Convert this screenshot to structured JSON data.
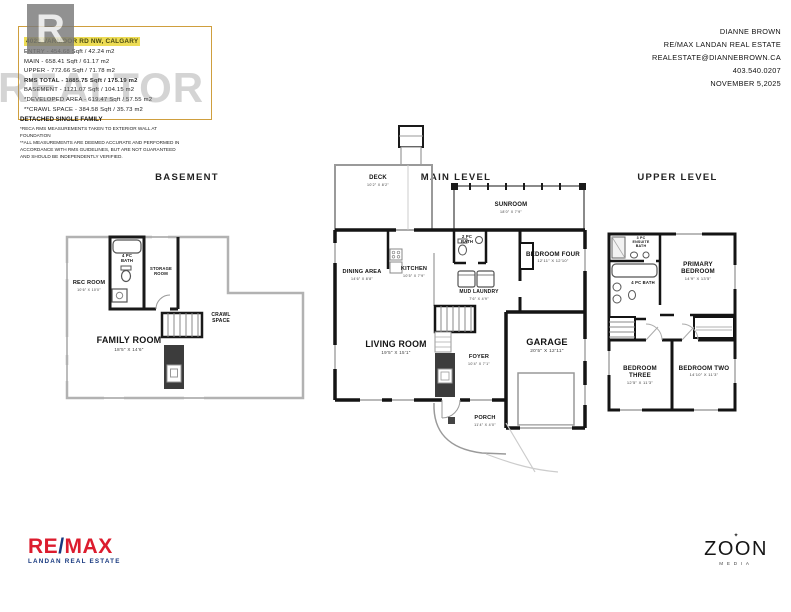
{
  "watermark": {
    "letter": "R",
    "text": "REALTOR"
  },
  "header": {
    "address": "4023 VARMOOR RD NW, CALGARY",
    "stats": [
      "ENTRY - 454.68 Sqft / 42.24 m2",
      "MAIN - 658.41 Sqft / 61.17 m2",
      "UPPER - 772.66 Sqft / 71.78 m2",
      "RMS TOTAL - 1885.75 Sqft / 175.19 m2",
      "BASEMENT - 1121.07 Sqft / 104.15 m2",
      "*DEVELOPED AREA - 619.47 Sqft / 57.55 m2",
      "**CRAWL SPACE - 384.58 Sqft / 35.73 m2"
    ],
    "property_type": "DETACHED SINGLE FAMILY",
    "disclaimer1": "*RECA RMS MEASUREMENTS TAKEN TO EXTERIOR WALL AT FOUNDATION",
    "disclaimer2": "**ALL MEASUREMENTS ARE DEEMED ACCURATE AND PERFORMED IN ACCORDANCE WITH RMS GUIDELINES, BUT ARE NOT GUARANTEED AND SHOULD BE INDEPENDENTLY VERIFIED."
  },
  "contact": {
    "name": "DIANNE BROWN",
    "brokerage": "RE/MAX LANDAN REAL ESTATE",
    "email": "REALESTATE@DIANNEBROWN.CA",
    "phone": "403.540.0207",
    "date": "NOVEMBER 5,2025"
  },
  "titles": {
    "basement": "BASEMENT",
    "main": "MAIN LEVEL",
    "upper": "UPPER LEVEL"
  },
  "plans": {
    "basement": {
      "rooms": {
        "rec": {
          "name": "REC ROOM",
          "dims": "10'6\" X 10'0\""
        },
        "bath": {
          "name": "4 PC BATH"
        },
        "storage": {
          "name": "STORAGE ROOM"
        },
        "crawl": {
          "name": "CRAWL SPACE"
        },
        "family": {
          "name": "FAMILY ROOM",
          "dims": "18'5\" X 14'6\""
        }
      }
    },
    "main": {
      "rooms": {
        "deck": {
          "name": "DECK",
          "dims": "10'2\" X 8'2\""
        },
        "sunroom": {
          "name": "SUNROOM",
          "dims": "18'0\" X 7'9\""
        },
        "bath": {
          "name": "2 PC BATH"
        },
        "bedroom_four": {
          "name": "BEDROOM FOUR",
          "dims": "12'11\" X 12'10\""
        },
        "dining": {
          "name": "DINING AREA",
          "dims": "14'6\" X 8'8\""
        },
        "kitchen": {
          "name": "KITCHEN",
          "dims": "10'5\" X 7'9\""
        },
        "mud_laundry": {
          "name": "MUD LAUNDRY",
          "dims": "7'6\" X 4'9\""
        },
        "living": {
          "name": "LIVING ROOM",
          "dims": "19'5\" X 15'1\""
        },
        "foyer": {
          "name": "FOYER",
          "dims": "10'4\" X 7'1\""
        },
        "garage": {
          "name": "GARAGE",
          "dims": "20'5\" X 12'11\""
        },
        "porch": {
          "name": "PORCH",
          "dims": "11'4\" X 4'0\""
        }
      }
    },
    "upper": {
      "rooms": {
        "ensuite": {
          "name": "3 PC ENSUITE BATH"
        },
        "bath": {
          "name": "4 PC BATH"
        },
        "primary": {
          "name": "PRIMARY BEDROOM",
          "dims": "14'9\" X 13'5\""
        },
        "bedroom_three": {
          "name": "BEDROOM THREE",
          "dims": "12'5\" X 11'3\""
        },
        "bedroom_two": {
          "name": "BEDROOM TWO",
          "dims": "14'10\" X 11'3\""
        }
      }
    }
  },
  "footer": {
    "remax_pre": "RE",
    "remax_slash": "/",
    "remax_post": "MAX",
    "remax_sub": "LANDAN REAL ESTATE",
    "zoon_star": "✦",
    "zoon_name": "ZOON",
    "zoon_sub": "MEDIA"
  }
}
